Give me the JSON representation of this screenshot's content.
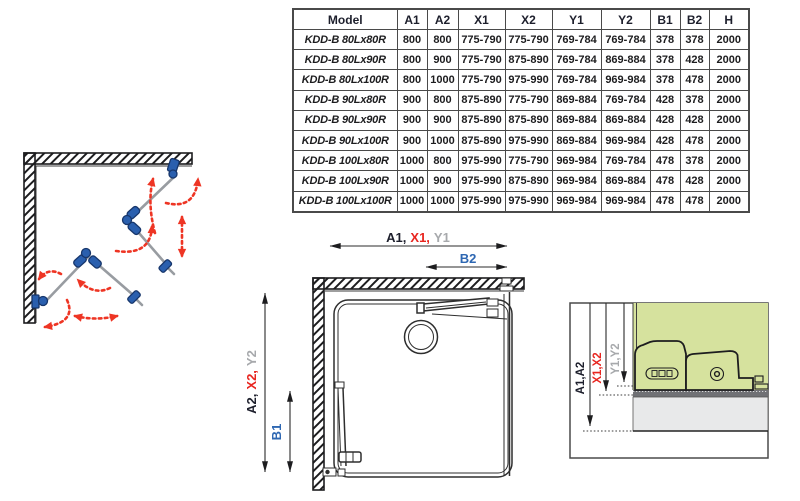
{
  "table": {
    "headers": [
      {
        "label": "Model",
        "color": "dark"
      },
      {
        "label": "A1",
        "color": "dark"
      },
      {
        "label": "A2",
        "color": "dark"
      },
      {
        "label": "X1",
        "color": "red"
      },
      {
        "label": "X2",
        "color": "red"
      },
      {
        "label": "Y1",
        "color": "gray"
      },
      {
        "label": "Y2",
        "color": "gray"
      },
      {
        "label": "B1",
        "color": "blue"
      },
      {
        "label": "B2",
        "color": "blue"
      },
      {
        "label": "H",
        "color": "dark"
      }
    ],
    "rows": [
      {
        "model": "KDD-B 80Lx80R",
        "values": [
          "800",
          "800",
          "775-790",
          "775-790",
          "769-784",
          "769-784",
          "378",
          "378",
          "2000"
        ]
      },
      {
        "model": "KDD-B 80Lx90R",
        "values": [
          "800",
          "900",
          "775-790",
          "875-890",
          "769-784",
          "869-884",
          "378",
          "428",
          "2000"
        ]
      },
      {
        "model": "KDD-B 80Lx100R",
        "values": [
          "800",
          "1000",
          "775-790",
          "975-990",
          "769-784",
          "969-984",
          "378",
          "478",
          "2000"
        ]
      },
      {
        "model": "KDD-B 90Lx80R",
        "values": [
          "900",
          "800",
          "875-890",
          "775-790",
          "869-884",
          "769-784",
          "428",
          "378",
          "2000"
        ]
      },
      {
        "model": "KDD-B 90Lx90R",
        "values": [
          "900",
          "900",
          "875-890",
          "875-890",
          "869-884",
          "869-884",
          "428",
          "428",
          "2000"
        ]
      },
      {
        "model": "KDD-B 90Lx100R",
        "values": [
          "900",
          "1000",
          "875-890",
          "975-990",
          "869-884",
          "969-984",
          "428",
          "478",
          "2000"
        ]
      },
      {
        "model": "KDD-B 100Lx80R",
        "values": [
          "1000",
          "800",
          "975-990",
          "775-790",
          "969-984",
          "769-784",
          "478",
          "378",
          "2000"
        ]
      },
      {
        "model": "KDD-B 100Lx90R",
        "values": [
          "1000",
          "900",
          "975-990",
          "875-890",
          "969-984",
          "869-884",
          "478",
          "428",
          "2000"
        ]
      },
      {
        "model": "KDD-B 100Lx100R",
        "values": [
          "1000",
          "1000",
          "975-990",
          "975-990",
          "969-984",
          "969-984",
          "478",
          "478",
          "2000"
        ]
      }
    ]
  },
  "plan_view": {
    "width_label": {
      "a1": "A1,",
      "x1": "X1,",
      "y1": "Y1"
    },
    "b2_label": "B2",
    "height_label": {
      "a2": "A2,",
      "x2": "X2,",
      "y2": "Y2"
    },
    "b1_label": "B1"
  },
  "detail_view": {
    "a_label": "A1,A2",
    "x_label": "X1,X2",
    "y_label": "Y1,Y2"
  },
  "colors": {
    "dimension_red": "#e8251f",
    "dimension_gray": "#a7a9ac",
    "dimension_blue": "#2e67b2",
    "table_text_dark": "#1d1f2c",
    "hinge_blue": "#2a5fae",
    "swing_arrow_red": "#ee3524",
    "glass_area_green": "#d6e29e",
    "floor_gray": "#e8e9ea",
    "seal_band_gray": "#707175"
  }
}
